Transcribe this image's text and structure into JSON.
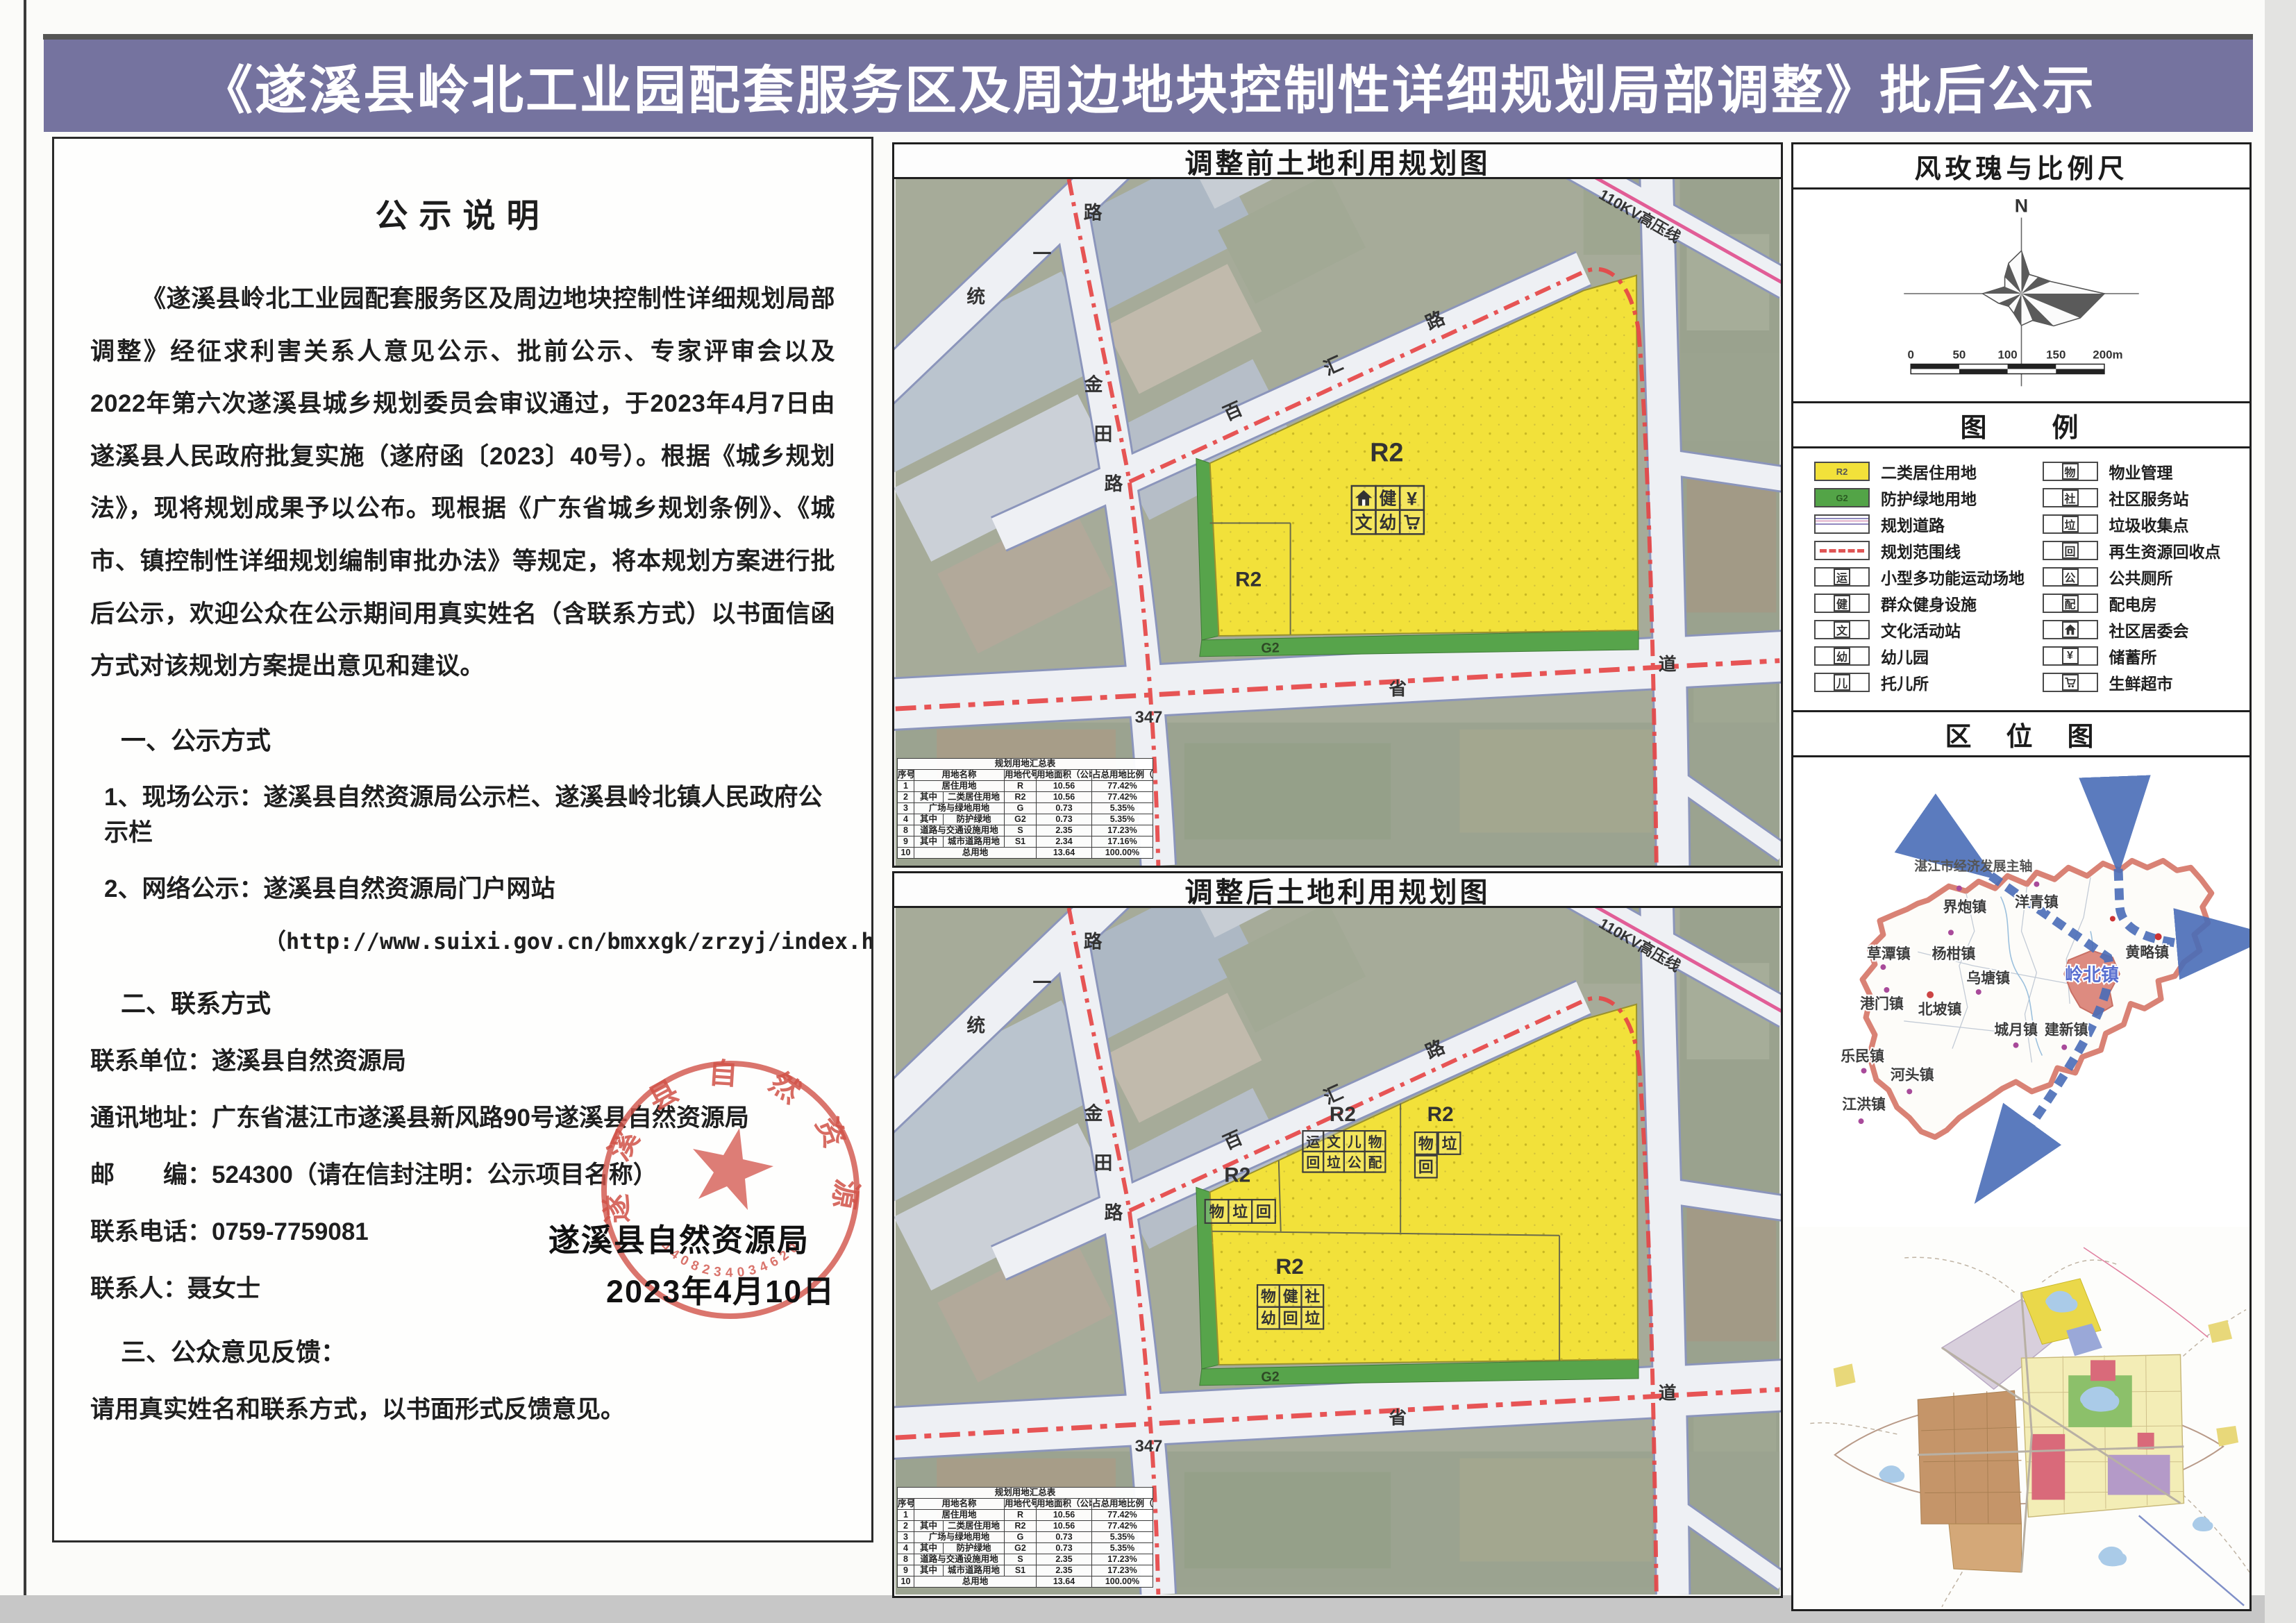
{
  "header": {
    "title": "《遂溪县岭北工业园配套服务区及周边地块控制性详细规划局部调整》批后公示",
    "accent_color": "#75739f"
  },
  "notice": {
    "heading": "公示说明",
    "paragraph": "《遂溪县岭北工业园配套服务区及周边地块控制性详细规划局部调整》经征求利害关系人意见公示、批前公示、专家评审会以及2022年第六次遂溪县城乡规划委员会审议通过，于2023年4月7日由遂溪县人民政府批复实施（遂府函〔2023〕40号）。根据《城乡规划法》，现将规划成果予以公布。现根据《广东省城乡规划条例》、《城市、镇控制性详细规划编制审批办法》等规定，将本规划方案进行批后公示，欢迎公众在公示期间用真实姓名（含联系方式）以书面信函方式对该规划方案提出意见和建议。",
    "section1_title": "一、公示方式",
    "item1": "1、现场公示：遂溪县自然资源局公示栏、遂溪县岭北镇人民政府公示栏",
    "item2": "2、网络公示：遂溪县自然资源局门户网站",
    "url": "（http://www.suixi.gov.cn/bmxxgk/zrzyj/index.html）",
    "section2_title": "二、联系方式",
    "contact_unit": "联系单位：遂溪县自然资源局",
    "contact_addr": "通讯地址：广东省湛江市遂溪县新风路90号遂溪县自然资源局",
    "contact_zip": "邮　　编：524300（请在信封注明：公示项目名称）",
    "contact_tel": "联系电话：0759-7759081",
    "contact_person": "联系人：聂女士",
    "section3_title": "三、公众意见反馈：",
    "feedback": "请用真实姓名和联系方式，以书面形式反馈意见。"
  },
  "stamp": {
    "org_line": "遂溪县自然资源局",
    "date_line": "2023年4月10日",
    "arc_text": "遂溪县自然资源局",
    "serial": "4408234034620",
    "color": "#d15248"
  },
  "maps": {
    "before_title": "调整前土地利用规划图",
    "after_title": "调整后土地利用规划图",
    "r2": "R2",
    "g2": "G2"
  },
  "roads": {
    "tongyi": [
      "统",
      "一",
      "路"
    ],
    "jintian": [
      "金",
      "田",
      "路"
    ],
    "baihui": [
      "百",
      "汇",
      "路"
    ],
    "kv_line": "110KV高压线",
    "sheng": "省",
    "dao": "道",
    "route_num": "347"
  },
  "icons_before": {
    "r1c2": "健",
    "r1c3": "¥",
    "r2c1": "文",
    "r2c2": "幼"
  },
  "icons_after": {
    "left": [
      "物",
      "垃",
      "回"
    ],
    "mid": [
      "运",
      "文",
      "儿",
      "物",
      "回",
      "垃",
      "公",
      "配"
    ],
    "right": [
      "物",
      "垃",
      "回"
    ],
    "bottom": [
      "物",
      "健",
      "社",
      "幼",
      "回",
      "垃"
    ]
  },
  "table": {
    "before": [
      [
        [
          "规划用地汇总表",
          6
        ]
      ],
      [
        [
          "序号",
          1
        ],
        [
          "用地名称",
          2
        ],
        [
          "用地代号",
          1
        ],
        [
          "用地面积（公顷）",
          1
        ],
        [
          "占总用地比例（%）",
          1
        ]
      ],
      [
        [
          "1",
          1
        ],
        [
          "居住用地",
          2
        ],
        [
          "R",
          1
        ],
        [
          "10.56",
          1
        ],
        [
          "77.42%",
          1
        ]
      ],
      [
        [
          "2",
          1
        ],
        [
          "其中",
          1
        ],
        [
          "二类居住用地",
          1
        ],
        [
          "R2",
          1
        ],
        [
          "10.56",
          1
        ],
        [
          "77.42%",
          1
        ]
      ],
      [
        [
          "3",
          1
        ],
        [
          "广场与绿地用地",
          2
        ],
        [
          "G",
          1
        ],
        [
          "0.73",
          1
        ],
        [
          "5.35%",
          1
        ]
      ],
      [
        [
          "4",
          1
        ],
        [
          "其中",
          1
        ],
        [
          "防护绿地",
          1
        ],
        [
          "G2",
          1
        ],
        [
          "0.73",
          1
        ],
        [
          "5.35%",
          1
        ]
      ],
      [
        [
          "8",
          1
        ],
        [
          "道路与交通设施用地",
          2
        ],
        [
          "S",
          1
        ],
        [
          "2.35",
          1
        ],
        [
          "17.23%",
          1
        ]
      ],
      [
        [
          "9",
          1
        ],
        [
          "其中",
          1
        ],
        [
          "城市道路用地",
          1
        ],
        [
          "S1",
          1
        ],
        [
          "2.34",
          1
        ],
        [
          "17.16%",
          1
        ]
      ],
      [
        [
          "10",
          1
        ],
        [
          "总用地",
          3
        ],
        [
          "13.64",
          1
        ],
        [
          "100.00%",
          1
        ]
      ]
    ],
    "after": [
      [
        [
          "规划用地汇总表",
          6
        ]
      ],
      [
        [
          "序号",
          1
        ],
        [
          "用地名称",
          2
        ],
        [
          "用地代号",
          1
        ],
        [
          "用地面积（公顷）",
          1
        ],
        [
          "占总用地比例（%）",
          1
        ]
      ],
      [
        [
          "1",
          1
        ],
        [
          "居住用地",
          2
        ],
        [
          "R",
          1
        ],
        [
          "10.56",
          1
        ],
        [
          "77.42%",
          1
        ]
      ],
      [
        [
          "2",
          1
        ],
        [
          "其中",
          1
        ],
        [
          "二类居住用地",
          1
        ],
        [
          "R2",
          1
        ],
        [
          "10.56",
          1
        ],
        [
          "77.42%",
          1
        ]
      ],
      [
        [
          "3",
          1
        ],
        [
          "广场与绿地用地",
          2
        ],
        [
          "G",
          1
        ],
        [
          "0.73",
          1
        ],
        [
          "5.35%",
          1
        ]
      ],
      [
        [
          "4",
          1
        ],
        [
          "其中",
          1
        ],
        [
          "防护绿地",
          1
        ],
        [
          "G2",
          1
        ],
        [
          "0.73",
          1
        ],
        [
          "5.35%",
          1
        ]
      ],
      [
        [
          "8",
          1
        ],
        [
          "道路与交通设施用地",
          2
        ],
        [
          "S",
          1
        ],
        [
          "2.35",
          1
        ],
        [
          "17.23%",
          1
        ]
      ],
      [
        [
          "9",
          1
        ],
        [
          "其中",
          1
        ],
        [
          "城市道路用地",
          1
        ],
        [
          "S1",
          1
        ],
        [
          "2.35",
          1
        ],
        [
          "17.23%",
          1
        ]
      ],
      [
        [
          "10",
          1
        ],
        [
          "总用地",
          3
        ],
        [
          "13.64",
          1
        ],
        [
          "100.00%",
          1
        ]
      ]
    ]
  },
  "windrose": {
    "title": "风玫瑰与比例尺",
    "north": "N",
    "radii": [
      62,
      30,
      34,
      46,
      120,
      92,
      66,
      42,
      46,
      30,
      26,
      36,
      56,
      26,
      34,
      48
    ],
    "scale_ticks": [
      "0",
      "50",
      "100",
      "150",
      "200m"
    ]
  },
  "legend": {
    "title": "图　　例",
    "left": [
      {
        "code": "R2",
        "label": "二类居住用地"
      },
      {
        "code": "G2",
        "label": "防护绿地用地"
      },
      {
        "label": "规划道路"
      },
      {
        "label": "规划范围线"
      },
      {
        "glyph": "运",
        "label": "小型多功能运动场地"
      },
      {
        "glyph": "健",
        "label": "群众健身设施"
      },
      {
        "glyph": "文",
        "label": "文化活动站"
      },
      {
        "glyph": "幼",
        "label": "幼儿园"
      },
      {
        "glyph": "儿",
        "label": "托儿所"
      }
    ],
    "right": [
      {
        "glyph": "物",
        "label": "物业管理"
      },
      {
        "glyph": "社",
        "label": "社区服务站"
      },
      {
        "glyph": "垃",
        "label": "垃圾收集点"
      },
      {
        "glyph": "回",
        "label": "再生资源回收点"
      },
      {
        "glyph": "公",
        "label": "公共厕所"
      },
      {
        "glyph": "配",
        "label": "配电房"
      },
      {
        "glyph": "",
        "label": "社区居委会"
      },
      {
        "glyph": "¥",
        "label": "储蓄所"
      },
      {
        "glyph": "",
        "label": "生鲜超市"
      }
    ]
  },
  "location": {
    "title": "区　位　图",
    "axis_label": "湛江市经济发展主轴",
    "towns": [
      {
        "name": "界炮镇"
      },
      {
        "name": "洋青镇"
      },
      {
        "name": "黄略镇"
      },
      {
        "name": "草潭镇"
      },
      {
        "name": "杨柑镇"
      },
      {
        "name": "乌塘镇"
      },
      {
        "name": "港门镇"
      },
      {
        "name": "北坡镇"
      },
      {
        "name": "乐民镇"
      },
      {
        "name": "河头镇"
      },
      {
        "name": "江洪镇"
      },
      {
        "name": "城月镇"
      },
      {
        "name": "建新镇"
      },
      {
        "name": "岭北镇"
      }
    ]
  }
}
